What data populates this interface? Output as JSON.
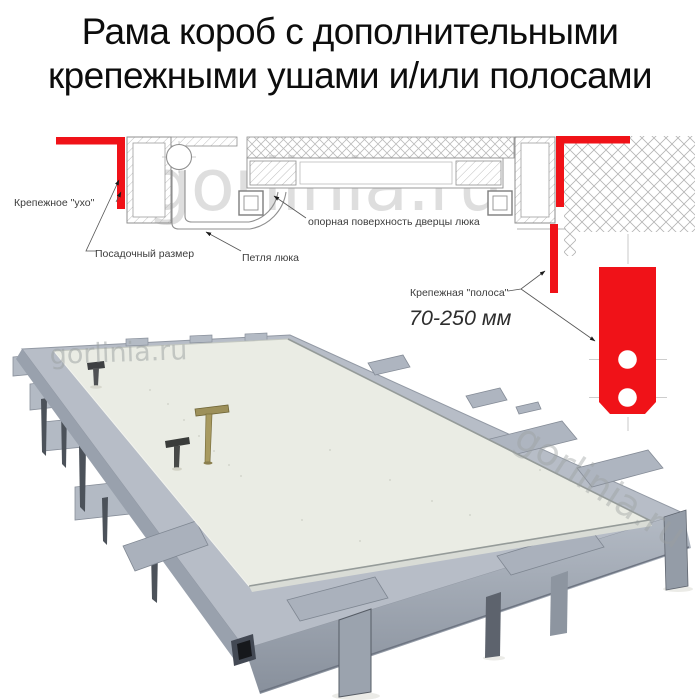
{
  "title": {
    "line1": "Рама короб с дополнительными",
    "line2": "крепежными ушами и/или полосами"
  },
  "diagram": {
    "labels": {
      "ear": "Крепежное \"ухо\"",
      "seat_size": "Посадочный размер",
      "hinge": "Петля люка",
      "support_surface": "опорная поверхность дверцы люка",
      "strip": "Крепежная \"полоса\"",
      "strip_range": "70-250 мм"
    },
    "colors": {
      "highlight_red": "#f01218",
      "line": "#8f8f8f",
      "hatch": "#b7b7b7"
    }
  },
  "watermark": {
    "text": "gorlinia.ru"
  },
  "photo": {
    "colors": {
      "frame": "#b7bdc7",
      "panel": "#eaece4",
      "legs": "#5d636d"
    }
  }
}
